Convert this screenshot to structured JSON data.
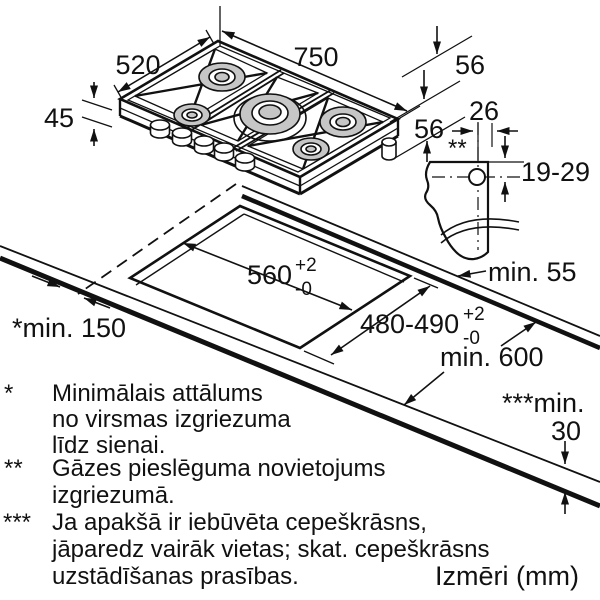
{
  "dims": {
    "w750": "750",
    "d520": "520",
    "h45": "45",
    "gas56_top": "56",
    "gas56_side": "56",
    "gas26": "26",
    "gas1929": "19-29",
    "gas_marker": "**",
    "cut_width": "560",
    "cut_width_tol_plus": "+2",
    "cut_width_tol_minus": "-0",
    "cut_depth": "480-490",
    "cut_depth_tol_plus": "+2",
    "cut_depth_tol_minus": "-0",
    "min_back": "min. 55",
    "min_side": "*min. 150",
    "min_depth": "min. 600",
    "min_thick_label": "***min.",
    "min_thick_value": "30"
  },
  "notes": {
    "n1": {
      "marker": "*",
      "l1": "Minimālais attālums",
      "l2": "no virsmas izgriezuma",
      "l3": "līdz sienai."
    },
    "n2": {
      "marker": "**",
      "l1": "Gāzes pieslēguma novietojums",
      "l2": "izgriezumā."
    },
    "n3": {
      "marker": "***",
      "l1": "Ja apakšā ir iebūvēta cepeškrāsns,",
      "l2": "jāparedz vairāk vietas; skat. cepeškrāsns",
      "l3": "uzstādīšanas prasības."
    }
  },
  "footer": {
    "units": "Izmēri (mm)"
  },
  "colors": {
    "line": "#111111",
    "burner_fill": "#c6c6c6",
    "background": "#ffffff"
  }
}
